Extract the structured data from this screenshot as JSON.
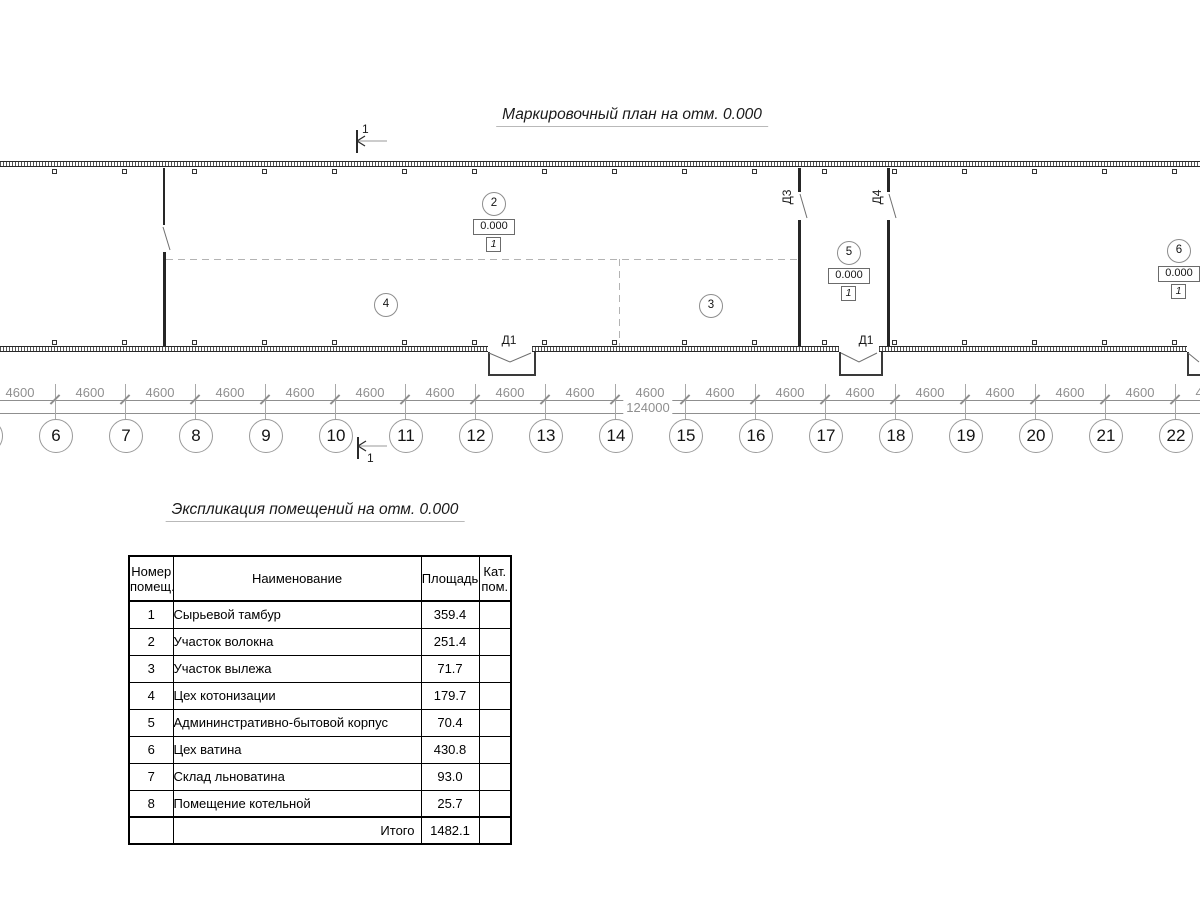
{
  "drawing": {
    "plan_title": "Маркировочный план на отм. 0.000",
    "section_mark_label": "1",
    "rooms": [
      {
        "num": "2",
        "x": 493,
        "y": 203,
        "has_elev": true,
        "elev": "0.000",
        "floor": "1"
      },
      {
        "num": "4",
        "x": 385,
        "y": 304,
        "has_elev": false,
        "elev": "",
        "floor": ""
      },
      {
        "num": "3",
        "x": 710,
        "y": 305,
        "has_elev": false,
        "elev": "",
        "floor": ""
      },
      {
        "num": "5",
        "x": 848,
        "y": 252,
        "has_elev": true,
        "elev": "0.000",
        "floor": "1"
      },
      {
        "num": "6",
        "x": 1178,
        "y": 250,
        "has_elev": true,
        "elev": "0.000",
        "floor": "1"
      }
    ],
    "door_labels": [
      {
        "text": "Д1",
        "x": 509,
        "y": 333,
        "vertical": false
      },
      {
        "text": "Д1",
        "x": 866,
        "y": 333,
        "vertical": false
      },
      {
        "text": "Д3",
        "x": 787,
        "y": 190,
        "vertical": true
      },
      {
        "text": "Д4",
        "x": 877,
        "y": 190,
        "vertical": true
      }
    ]
  },
  "dimensions": {
    "bay_value": "4600",
    "bay_count": 18,
    "total_value": "124000",
    "axis_labels": [
      "",
      "6",
      "7",
      "8",
      "9",
      "10",
      "11",
      "12",
      "13",
      "14",
      "15",
      "16",
      "17",
      "18",
      "19",
      "20",
      "21",
      "22"
    ]
  },
  "schedule": {
    "title": "Экспликация помещений на отм. 0.000",
    "headers": [
      "Номер\nпомещ.",
      "Наименование",
      "Площадь",
      "Кат.\nпом."
    ],
    "rows": [
      {
        "num": "1",
        "name": "Сырьевой тамбур",
        "area": "359.4",
        "cat": ""
      },
      {
        "num": "2",
        "name": "Участок волокна",
        "area": "251.4",
        "cat": ""
      },
      {
        "num": "3",
        "name": "Участок вылежа",
        "area": "71.7",
        "cat": ""
      },
      {
        "num": "4",
        "name": "Цех котонизации",
        "area": "179.7",
        "cat": ""
      },
      {
        "num": "5",
        "name": "Админинстративно-бытовой корпус",
        "area": "70.4",
        "cat": ""
      },
      {
        "num": "6",
        "name": "Цех ватина",
        "area": "430.8",
        "cat": ""
      },
      {
        "num": "7",
        "name": "Склад льноватина",
        "area": "93.0",
        "cat": ""
      },
      {
        "num": "8",
        "name": "Помещение котельной",
        "area": "25.7",
        "cat": ""
      }
    ],
    "total_label": "Итого",
    "total_value": "1482.1"
  },
  "colors": {
    "ink": "#1a1a1a",
    "dim_gray": "#8f8f8f",
    "axis_circle_gray": "#9a9a9a",
    "dashed_gray": "#b3b3b3"
  }
}
